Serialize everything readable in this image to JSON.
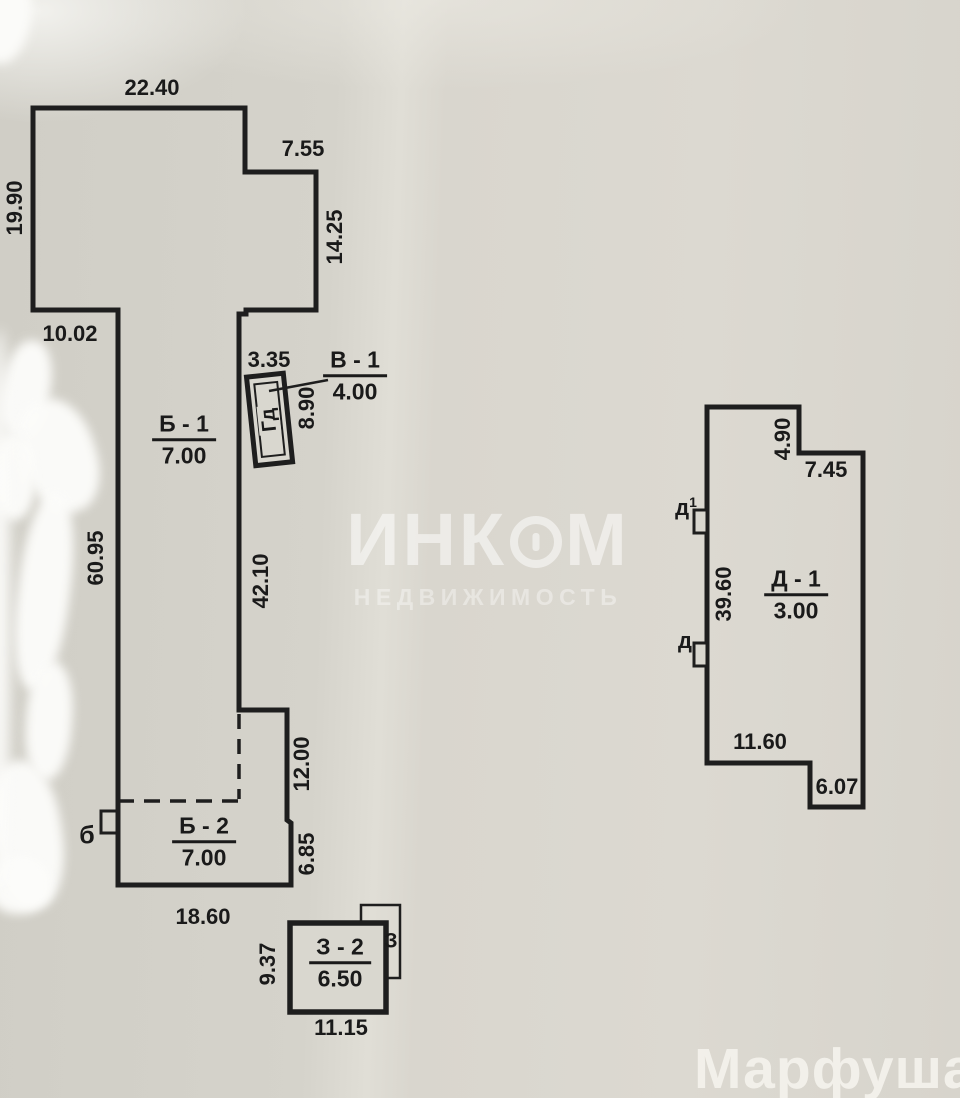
{
  "colors": {
    "paper": "#d7d5cd",
    "line": "#1e1e1e",
    "text": "#1a1a1a"
  },
  "plan": {
    "building_b": {
      "top_width": "22.40",
      "notch_width": "7.55",
      "left_height": "19.90",
      "right_height": "14.25",
      "ledge_width": "10.02",
      "stem_left_height": "60.95",
      "stem_right_height": "42.10",
      "lower_right_height": "12.00",
      "lower_right_step_height": "6.85",
      "bottom_width": "18.60",
      "porch_label": "б",
      "room_upper": {
        "name": "Б - 1",
        "value": "7.00"
      },
      "room_lower": {
        "name": "Б - 2",
        "value": "7.00"
      }
    },
    "structure_g": {
      "width": "3.35",
      "side_height": "8.90",
      "label": "Гд"
    },
    "callout_v": {
      "name": "В - 1",
      "value": "4.00"
    },
    "structure_z": {
      "name": "З - 2",
      "value": "6.50",
      "left_height": "9.37",
      "bottom_width": "11.15",
      "back_label": "З"
    },
    "building_d": {
      "step_height": "4.90",
      "top_width": "7.45",
      "left_height": "39.60",
      "entry1_label": "д",
      "entry1_sup": "1",
      "entry2_label": "д",
      "room": {
        "name": "Д - 1",
        "value": "3.00"
      },
      "bottom_width": "11.60",
      "bottom_step_width": "6.07"
    }
  },
  "watermark": {
    "brand_prefix": "ИНК",
    "brand_suffix": "М",
    "tagline": "НЕДВИЖИМОСТЬ"
  },
  "signature": "Марфуша"
}
